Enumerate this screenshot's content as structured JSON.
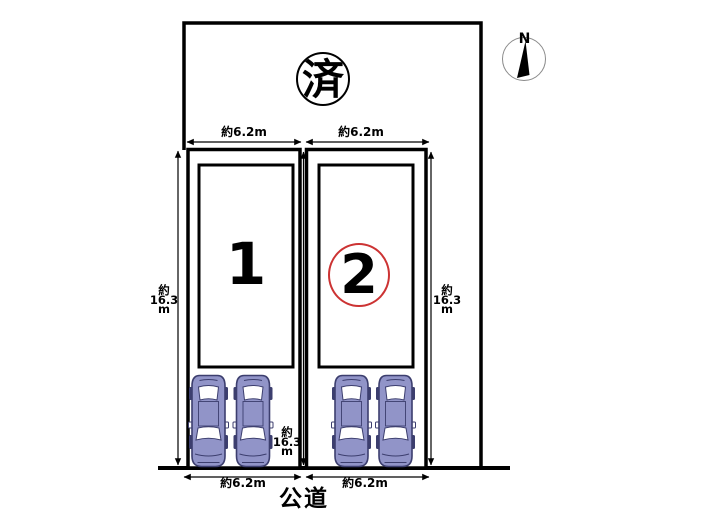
{
  "diagram": {
    "sold_mark": "済",
    "compass": {
      "label": "N"
    },
    "road": {
      "label": "公道"
    },
    "plots": [
      {
        "number": "1",
        "width_top": "約6.2m",
        "width_bottom": "約6.2m",
        "circled": false
      },
      {
        "number": "2",
        "width_top": "約6.2m",
        "width_bottom": "約6.2m",
        "circled": true
      }
    ],
    "depth_labels": [
      {
        "position": "left",
        "l1": "約",
        "l2": "16.3",
        "l3": "m"
      },
      {
        "position": "center",
        "l1": "約",
        "l2": "16.3",
        "l3": "m"
      },
      {
        "position": "right",
        "l1": "約",
        "l2": "16.3",
        "l3": "m"
      }
    ],
    "colors": {
      "line": "#000000",
      "highlight_circle": "#cc3333",
      "car_body": "#9194c8",
      "car_window": "#ffffff",
      "car_outline": "#3c3e6e",
      "compass_ring": "#8a8a8a"
    }
  }
}
